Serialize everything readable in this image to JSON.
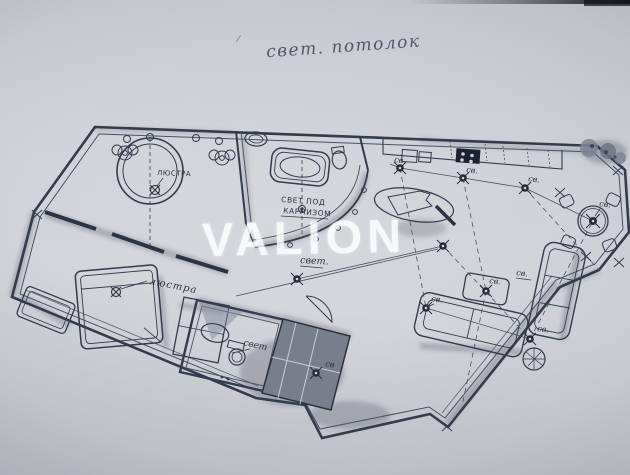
{
  "photo": {
    "annotation_title": "свет. потолок",
    "watermark": "VALION"
  },
  "labels": {
    "tub_chandelier": "ЛЮСТРА",
    "bed_chandelier": "люстра",
    "cornice_light_1": "СВЕТ ПОД",
    "cornice_light_2": "КАРНИЗОМ",
    "hall_light": "свет.",
    "wc_light": "свет",
    "spot": "св.",
    "spot_plain": "св"
  },
  "colors": {
    "paper": "#cbced5",
    "ink": "#343b4d",
    "watermark": "#ffffff"
  }
}
